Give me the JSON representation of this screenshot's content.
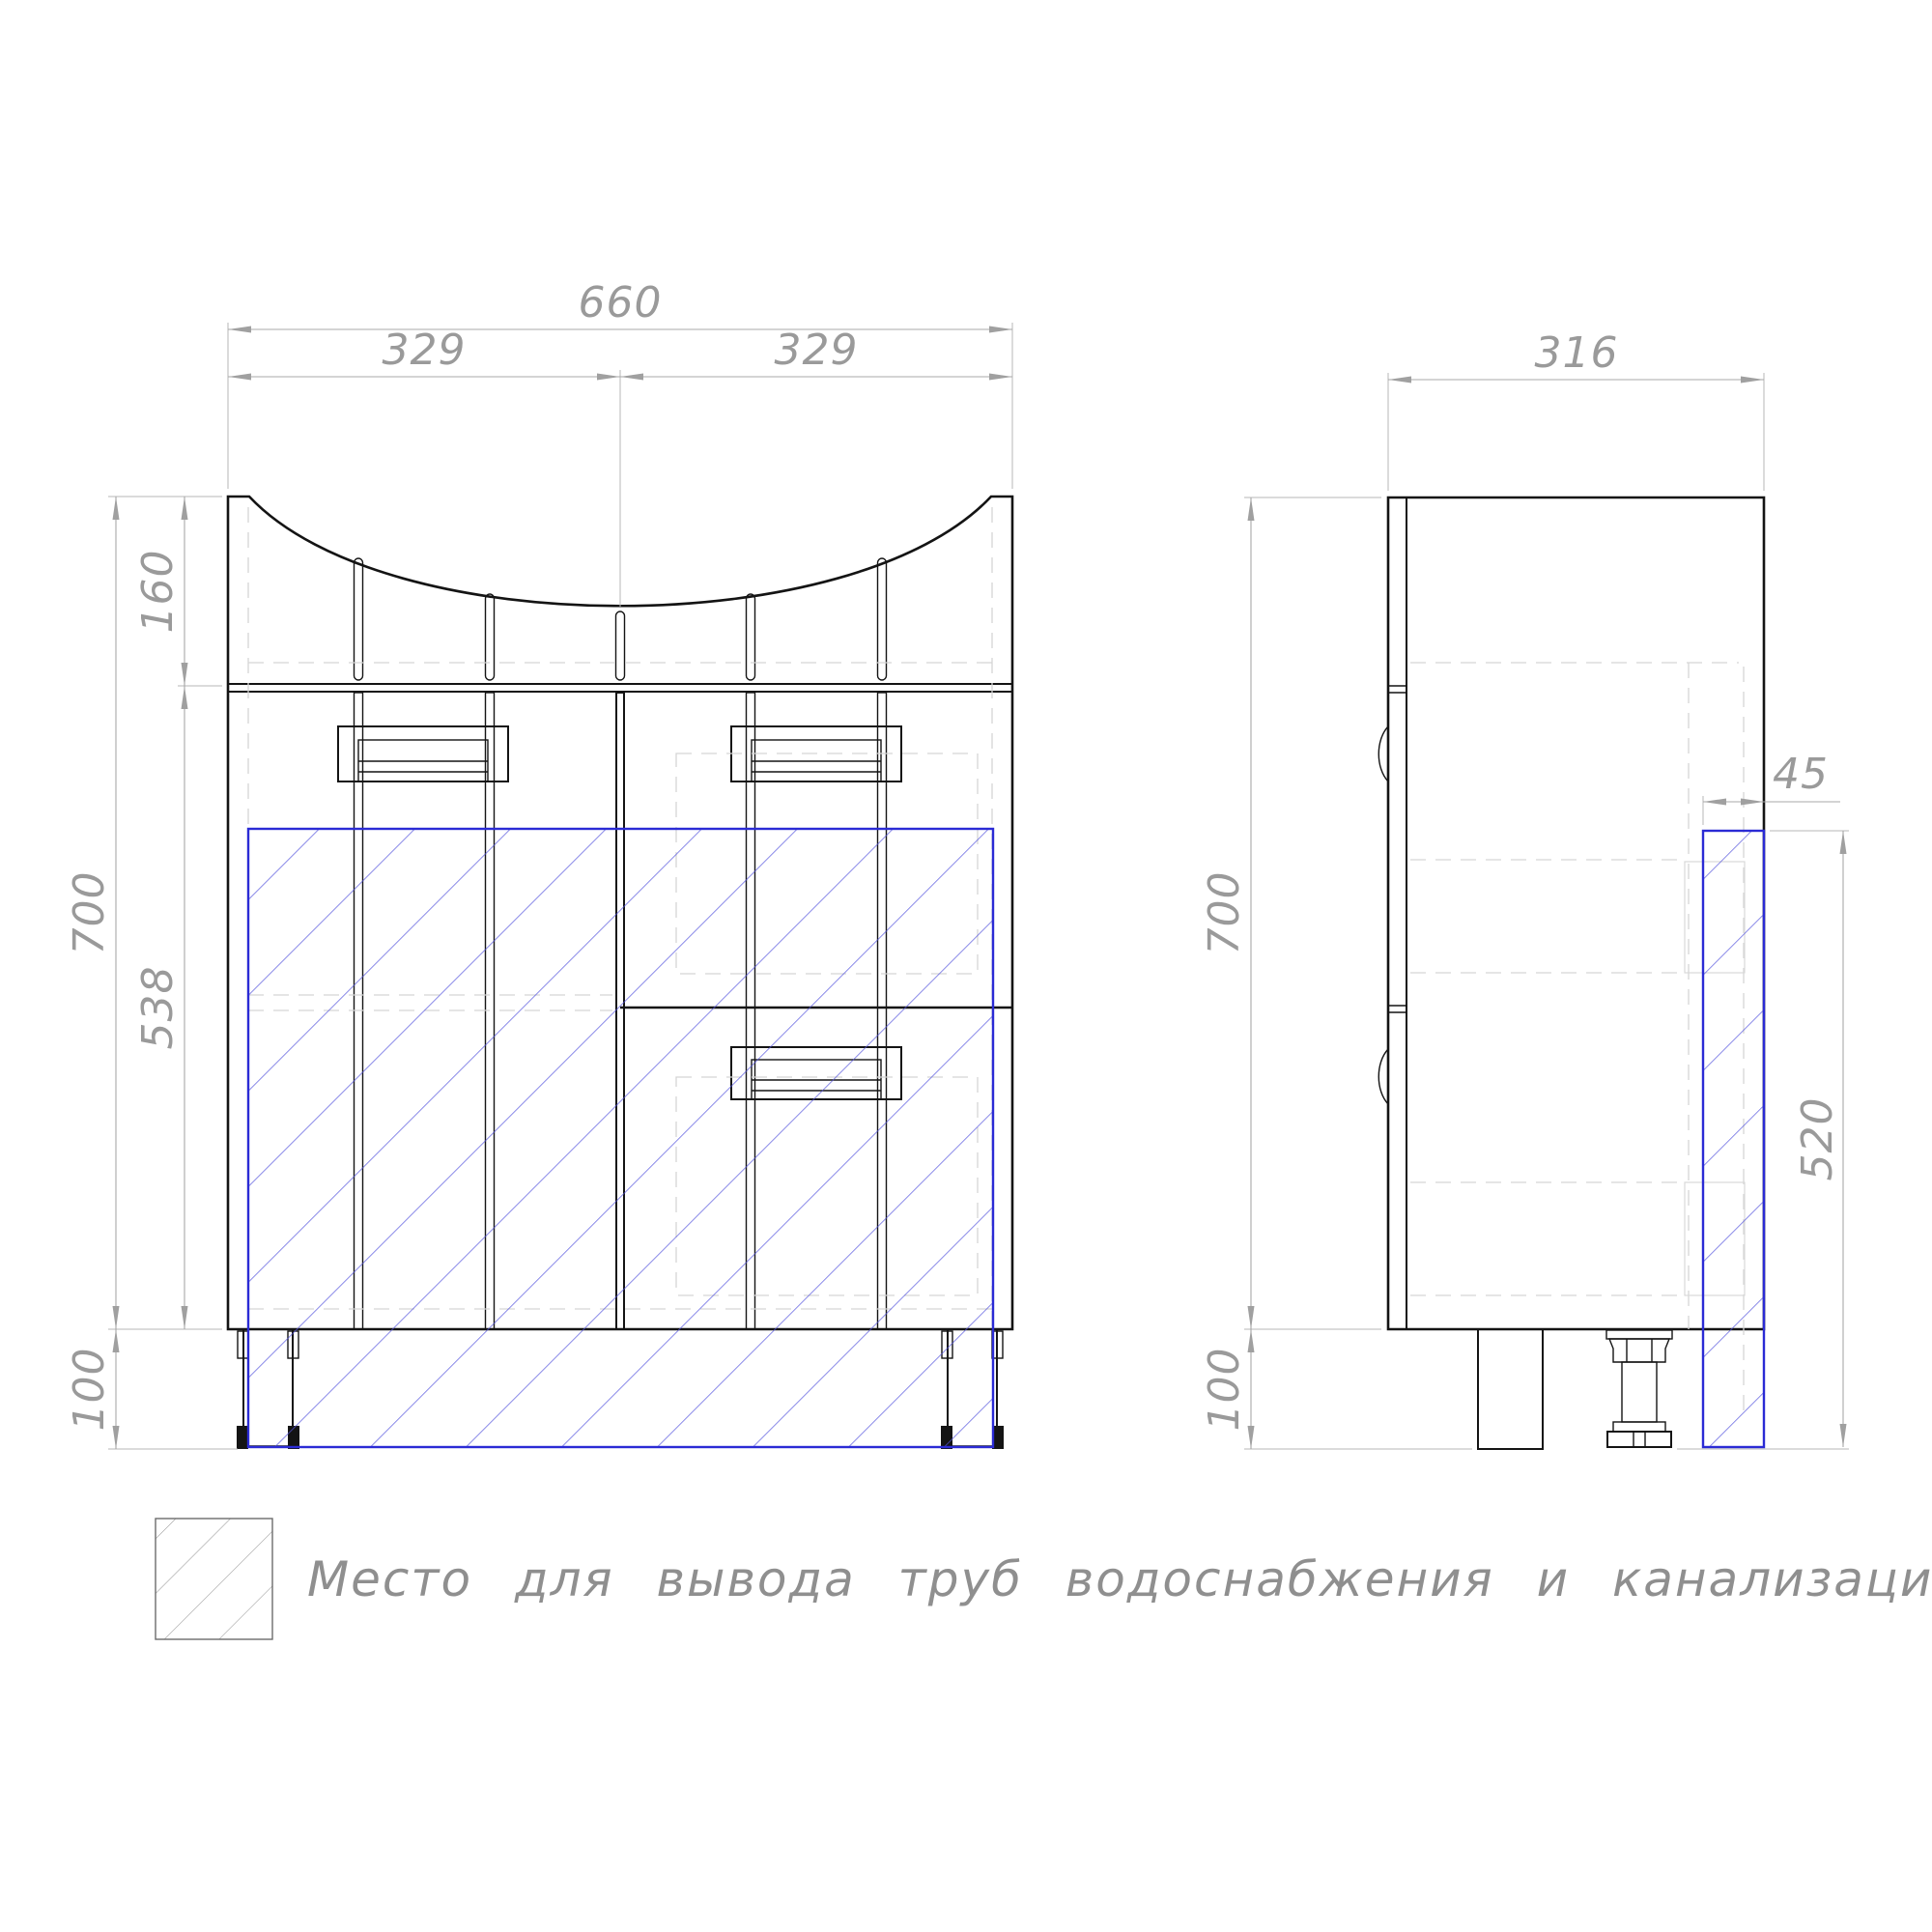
{
  "drawing_type": "cabinet technical drawing, front and side views",
  "front_view": {
    "width_total": "660",
    "width_left_half": "329",
    "width_right_half": "329",
    "apron_height": "160",
    "body_height": "538",
    "cabinet_height": "700",
    "legs_height": "100"
  },
  "side_view": {
    "depth": "316",
    "pipe_zone_width": "45",
    "cabinet_height": "700",
    "pipe_zone_height": "520",
    "legs_height": "100"
  },
  "legend": {
    "label": "Место для вывода труб водоснабжения и канализации"
  },
  "colors": {
    "outline": "#141414",
    "dimension": "#9a9a9a",
    "hidden_line": "#d5d5d5",
    "pipe_zone": "#2b2bd5"
  }
}
